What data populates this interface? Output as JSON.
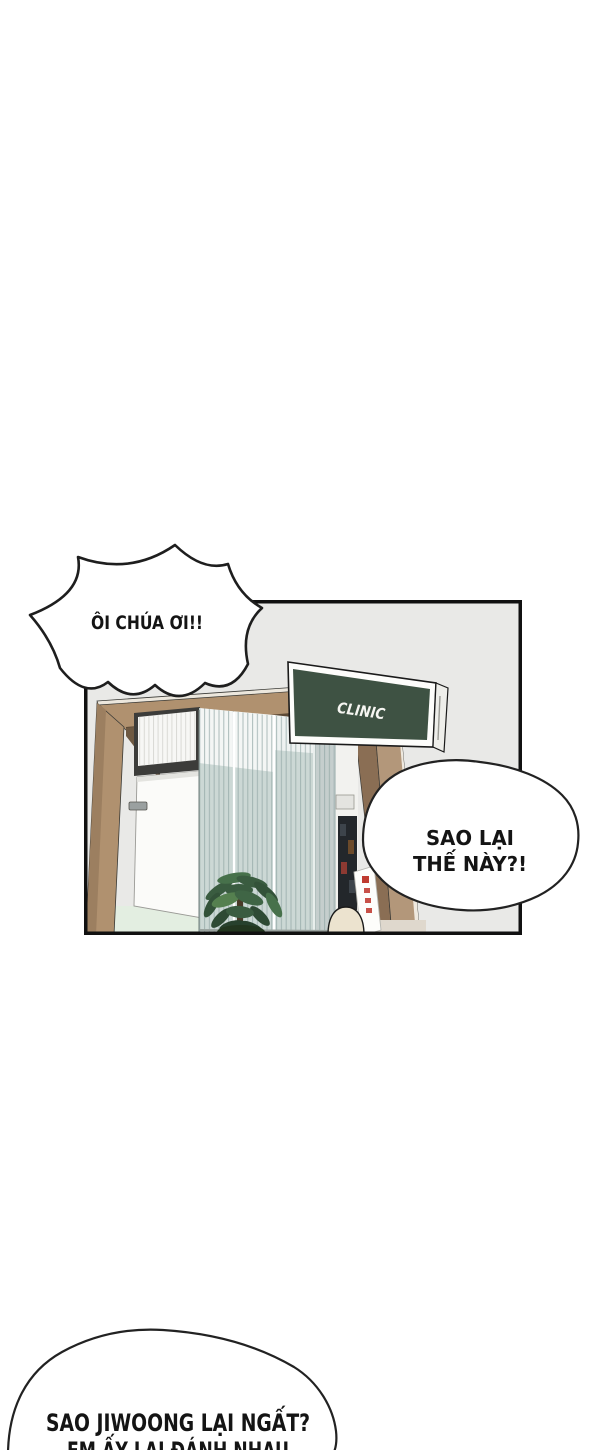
{
  "panel": {
    "sign": {
      "label": "CLINIC"
    }
  },
  "speech_bubbles": {
    "shout": {
      "text": "ÔI CHÚA ƠI!!"
    },
    "question": {
      "line1": "SAO LẠI",
      "line2": "THẾ NÀY?!"
    },
    "offpanel": {
      "line1": "SAO JIWOONG LẠI NGẤT?",
      "line2": "EM ẤY LẠI ĐÁNH NHAU"
    }
  },
  "colors": {
    "wall_gray": "#e9e9e7",
    "wood": "#b0916f",
    "wood_dark": "#63503a",
    "curtain": "#ccd8d5",
    "curtain_stripe": "#93a8a6",
    "floor_mint": "#e3eee1",
    "sign_green": "#3e5243",
    "plant_green": "#3a5c40",
    "accent_red": "#bf3a2f",
    "outline_black": "#111111"
  }
}
